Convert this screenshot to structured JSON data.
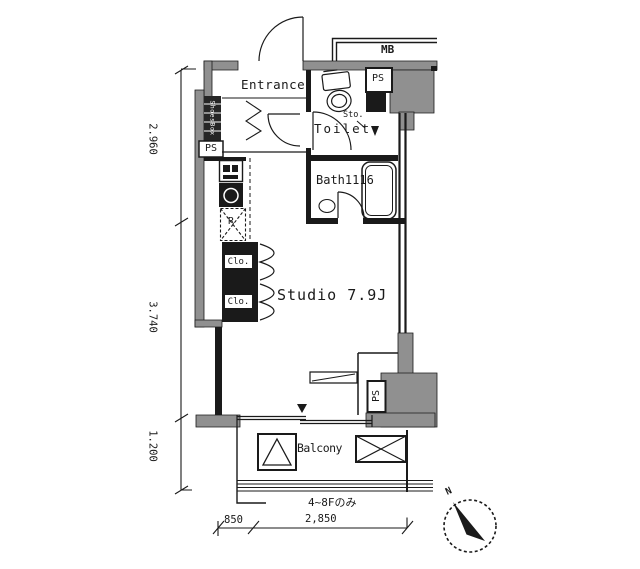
{
  "rooms": {
    "entrance": {
      "label": "Entrance"
    },
    "toilet": {
      "label": "Toilet",
      "storage": "Sto."
    },
    "bath": {
      "label": "Bath1116"
    },
    "studio": {
      "label": "Studio 7.9J"
    },
    "balcony": {
      "label": "Balcony"
    }
  },
  "fixtures": {
    "shoes_box": {
      "label": "ShoesBox"
    },
    "refrigerator": {
      "label": "R"
    },
    "closets": [
      {
        "label": "Clo."
      },
      {
        "label": "Clo."
      }
    ]
  },
  "service": {
    "meter_box": "MB",
    "pipe_space_top": "PS",
    "pipe_space_left": "PS",
    "pipe_space_bottom": "PS"
  },
  "dimensions": {
    "left": [
      {
        "label": "2.960"
      },
      {
        "label": "3.740"
      },
      {
        "label": "1.200"
      }
    ],
    "bottom": [
      {
        "label": "850"
      },
      {
        "label": "2,850"
      }
    ]
  },
  "notes": {
    "floor_range": "4~8Fのみ"
  },
  "compass": {
    "north": "N"
  },
  "colors": {
    "wall_gray": "#909090",
    "line_black": "#1a1a1a",
    "background": "#ffffff"
  }
}
